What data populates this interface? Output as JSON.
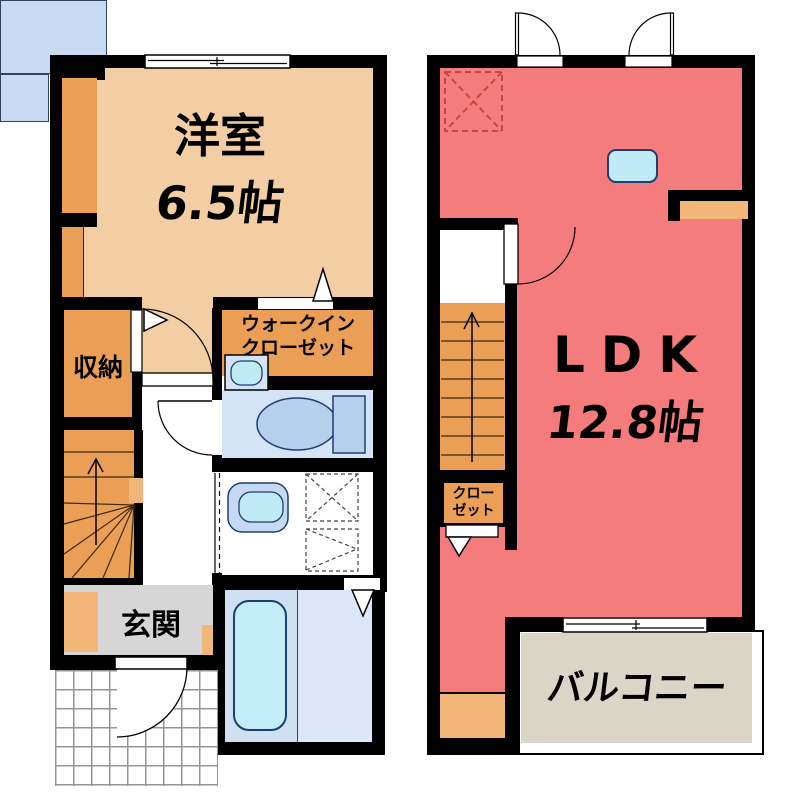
{
  "plan": {
    "floor1": {
      "western_room": {
        "name": "洋室",
        "size": "6.5帖"
      },
      "storage": {
        "name": "収納"
      },
      "walk_in_closet": {
        "line1": "ウォークイン",
        "line2": "クローゼット"
      },
      "entrance": {
        "name": "玄関"
      }
    },
    "floor2": {
      "ldk": {
        "name": "LDK",
        "size": "12.8帖"
      },
      "closet": {
        "line1": "クロー",
        "line2": "ゼット"
      },
      "balcony": {
        "name": "バルコニー"
      }
    },
    "colors": {
      "wall": "#000000",
      "western_room": "#f3cda4",
      "orange_room": "#eb9e55",
      "orange_light": "#f2b679",
      "ldk_red": "#f47c7c",
      "kitchen_counter": "#c8daf2",
      "fixture_blue": "#b9cfee",
      "sink_cyan": "#bfeaf6",
      "toilet_room": "#d5e3f6",
      "bath_left": "#cfe0f2",
      "bath_right": "#dce8f7",
      "bathtub": "#c3eef9",
      "entrance_gray": "#d6d6d6",
      "balcony_beige": "#dbd5c7",
      "dashed_red": "#cc4444"
    }
  }
}
